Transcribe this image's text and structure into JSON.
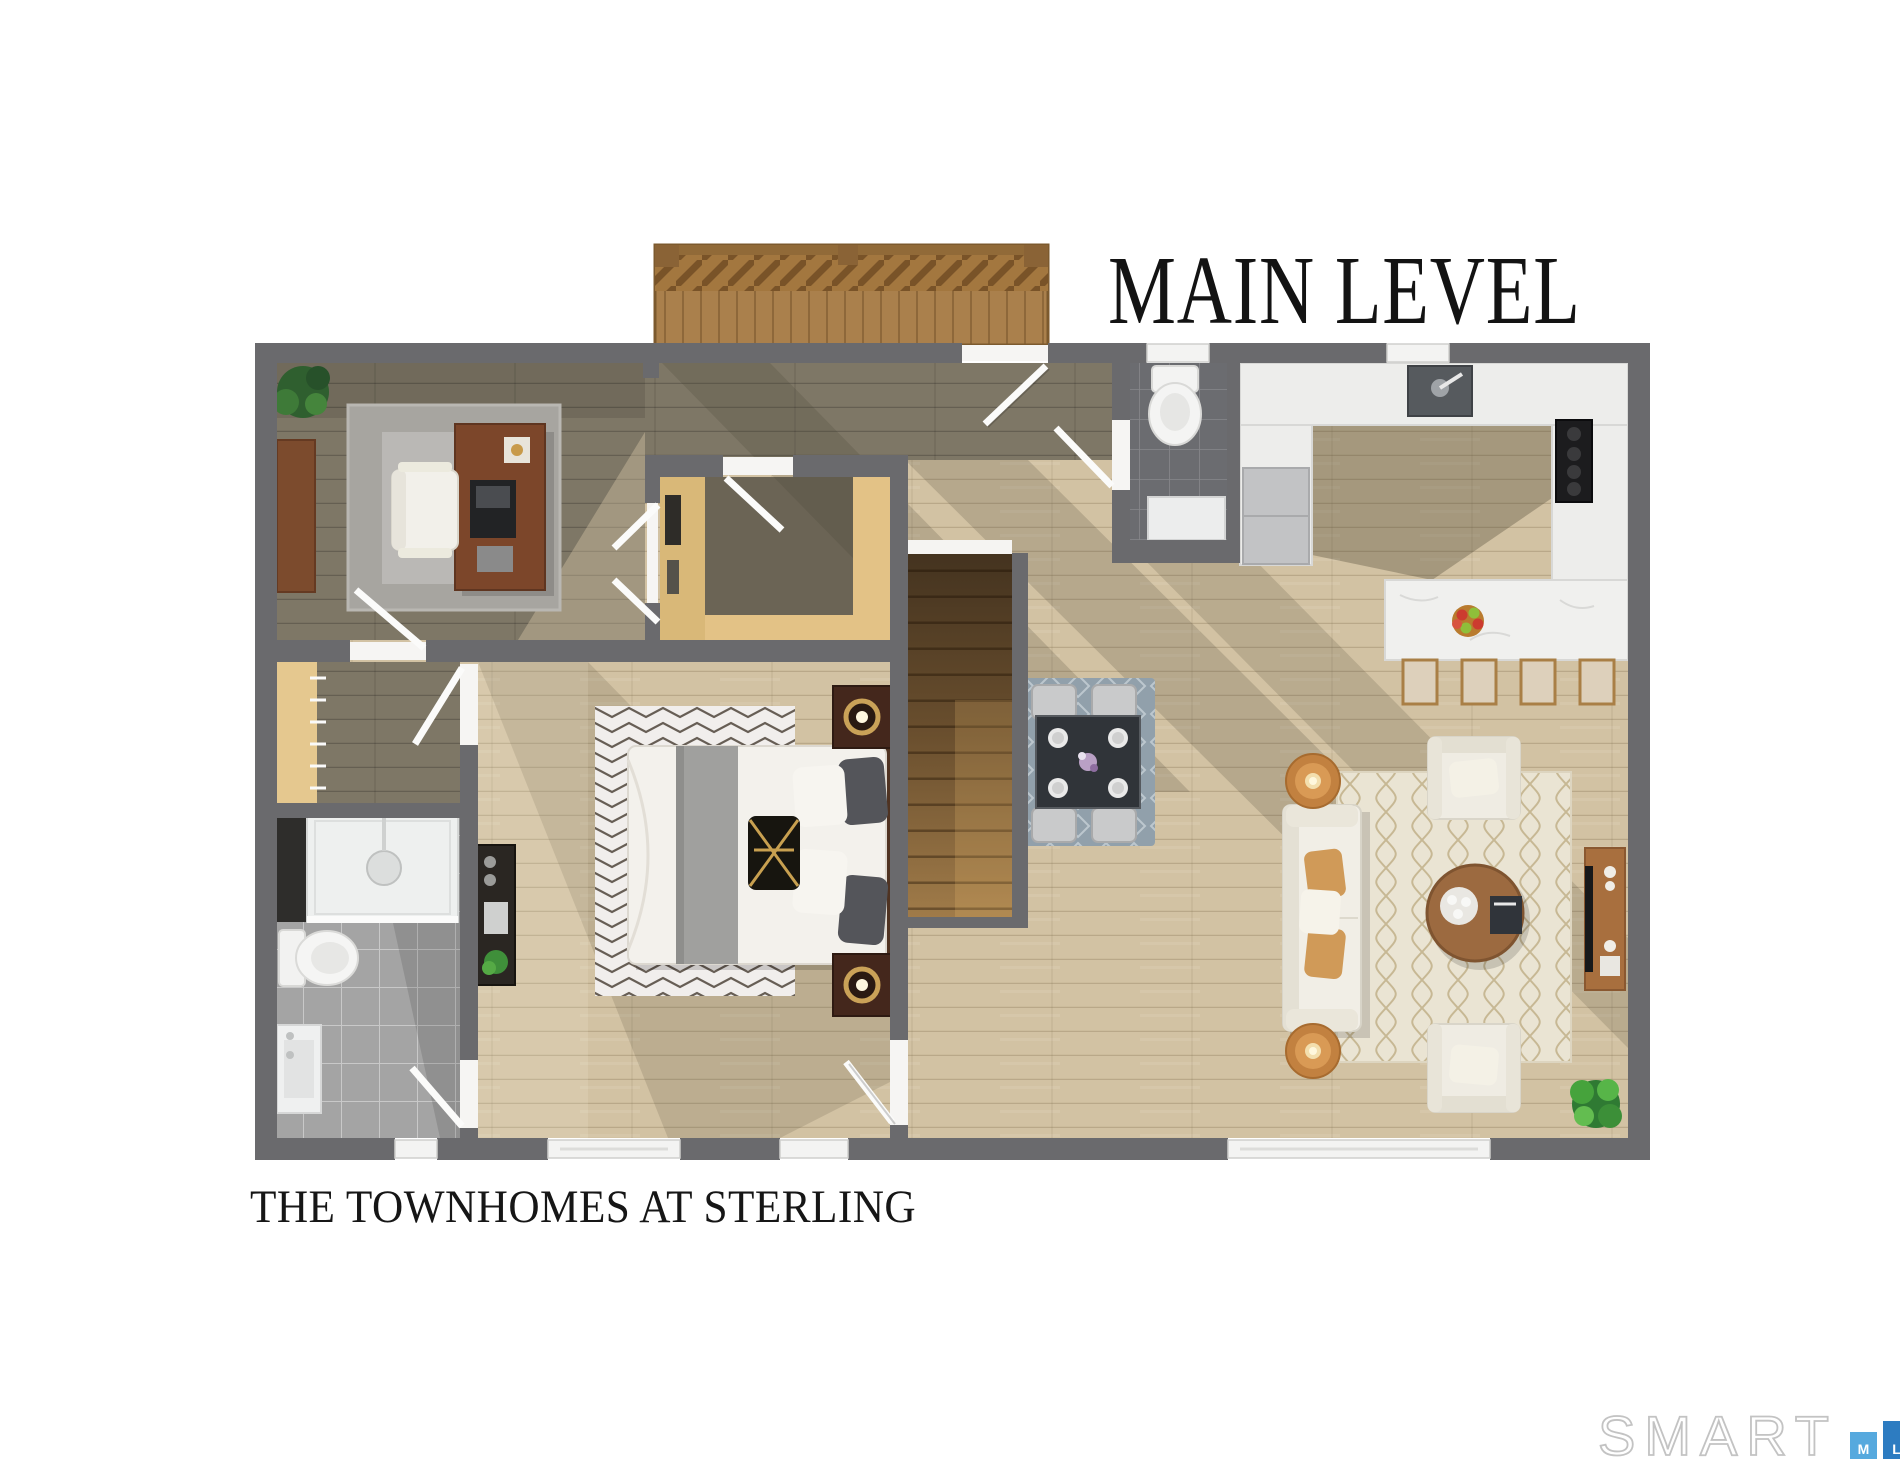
{
  "title": {
    "text": "MAIN LEVEL"
  },
  "caption": {
    "text": "THE TOWNHOMES AT STERLING"
  },
  "logo": {
    "wordmark": "SMART",
    "bars": [
      {
        "letter": "M",
        "color": "#56a9de"
      },
      {
        "letter": "L",
        "color": "#2d7cc1"
      },
      {
        "letter": "S",
        "color": "#2b4a60"
      }
    ]
  },
  "palette": {
    "wall_gray": "#6a6a6d",
    "floor_light_wood": "#d2c2a3",
    "floor_dark_wood": "#7e7766",
    "deck_wood": "#aa804c",
    "counter_white": "#ededeb",
    "tile_light": "#a4a4a4",
    "tile_dark": "#6b6c70",
    "stair_dark": "#4a3827",
    "stair_light": "#9d7949",
    "rug_living": "#eae4d3",
    "rug_dining": "#91a0ab",
    "rug_bedroom": "#f1eeec",
    "accent_orange": "#cf9a57",
    "plant_green": "#3f8f3a",
    "furniture_wood": "#9c6a40",
    "title_ink": "#131313"
  }
}
